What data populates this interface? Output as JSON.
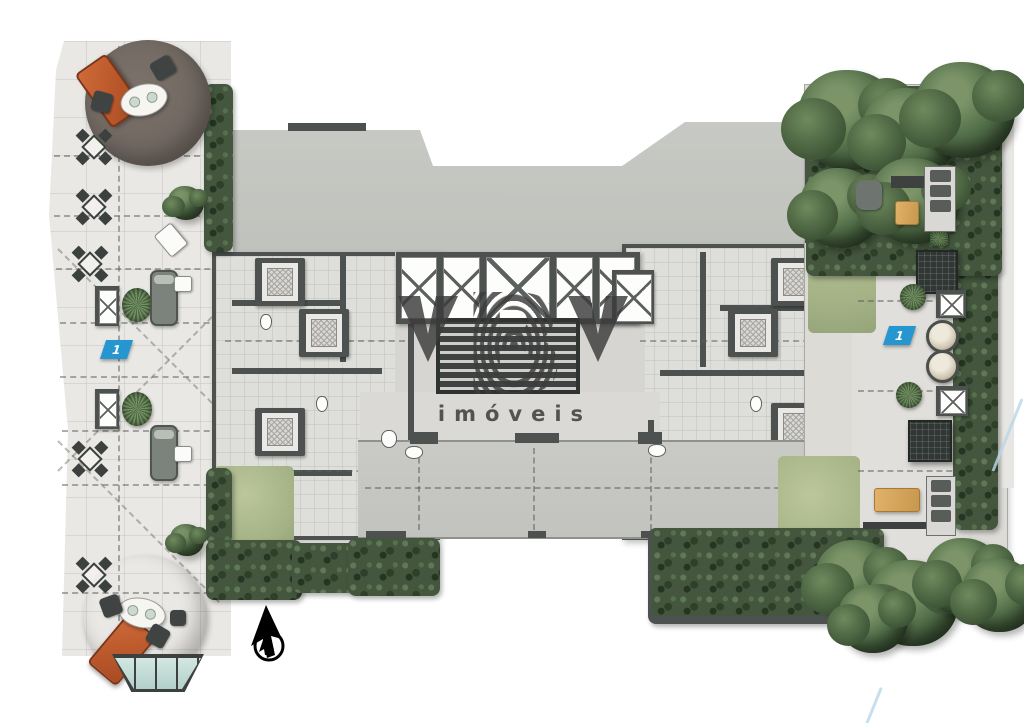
{
  "image": {
    "kind": "residential-rooftop-floor-plan",
    "background": "#ffffff"
  },
  "watermark": {
    "letter_left": "V",
    "letter_center": "B",
    "letter_right": "V",
    "subtitle": "imóveis",
    "ink": "#3c3c3c"
  },
  "markers": {
    "left_terrace_label": "1",
    "right_garden_label": "1",
    "fill": "#2596cf"
  },
  "palette": {
    "paving": "#e9e8e4",
    "slab": "#c4c6c1",
    "wall": "#4d5250",
    "floor": "#dededa",
    "hedge": "#44573e",
    "lawn": "#aebd90",
    "rug_top": "#6f6660",
    "rug_bottom": "#8a7e71",
    "orange": "#bf5a2c",
    "glass": "#bedad6",
    "wood": "#d9a960",
    "marker": "#2596cf",
    "ink": "#3c3c3c"
  },
  "cursor": {
    "icon": "arrow-pointer-with-circle"
  }
}
